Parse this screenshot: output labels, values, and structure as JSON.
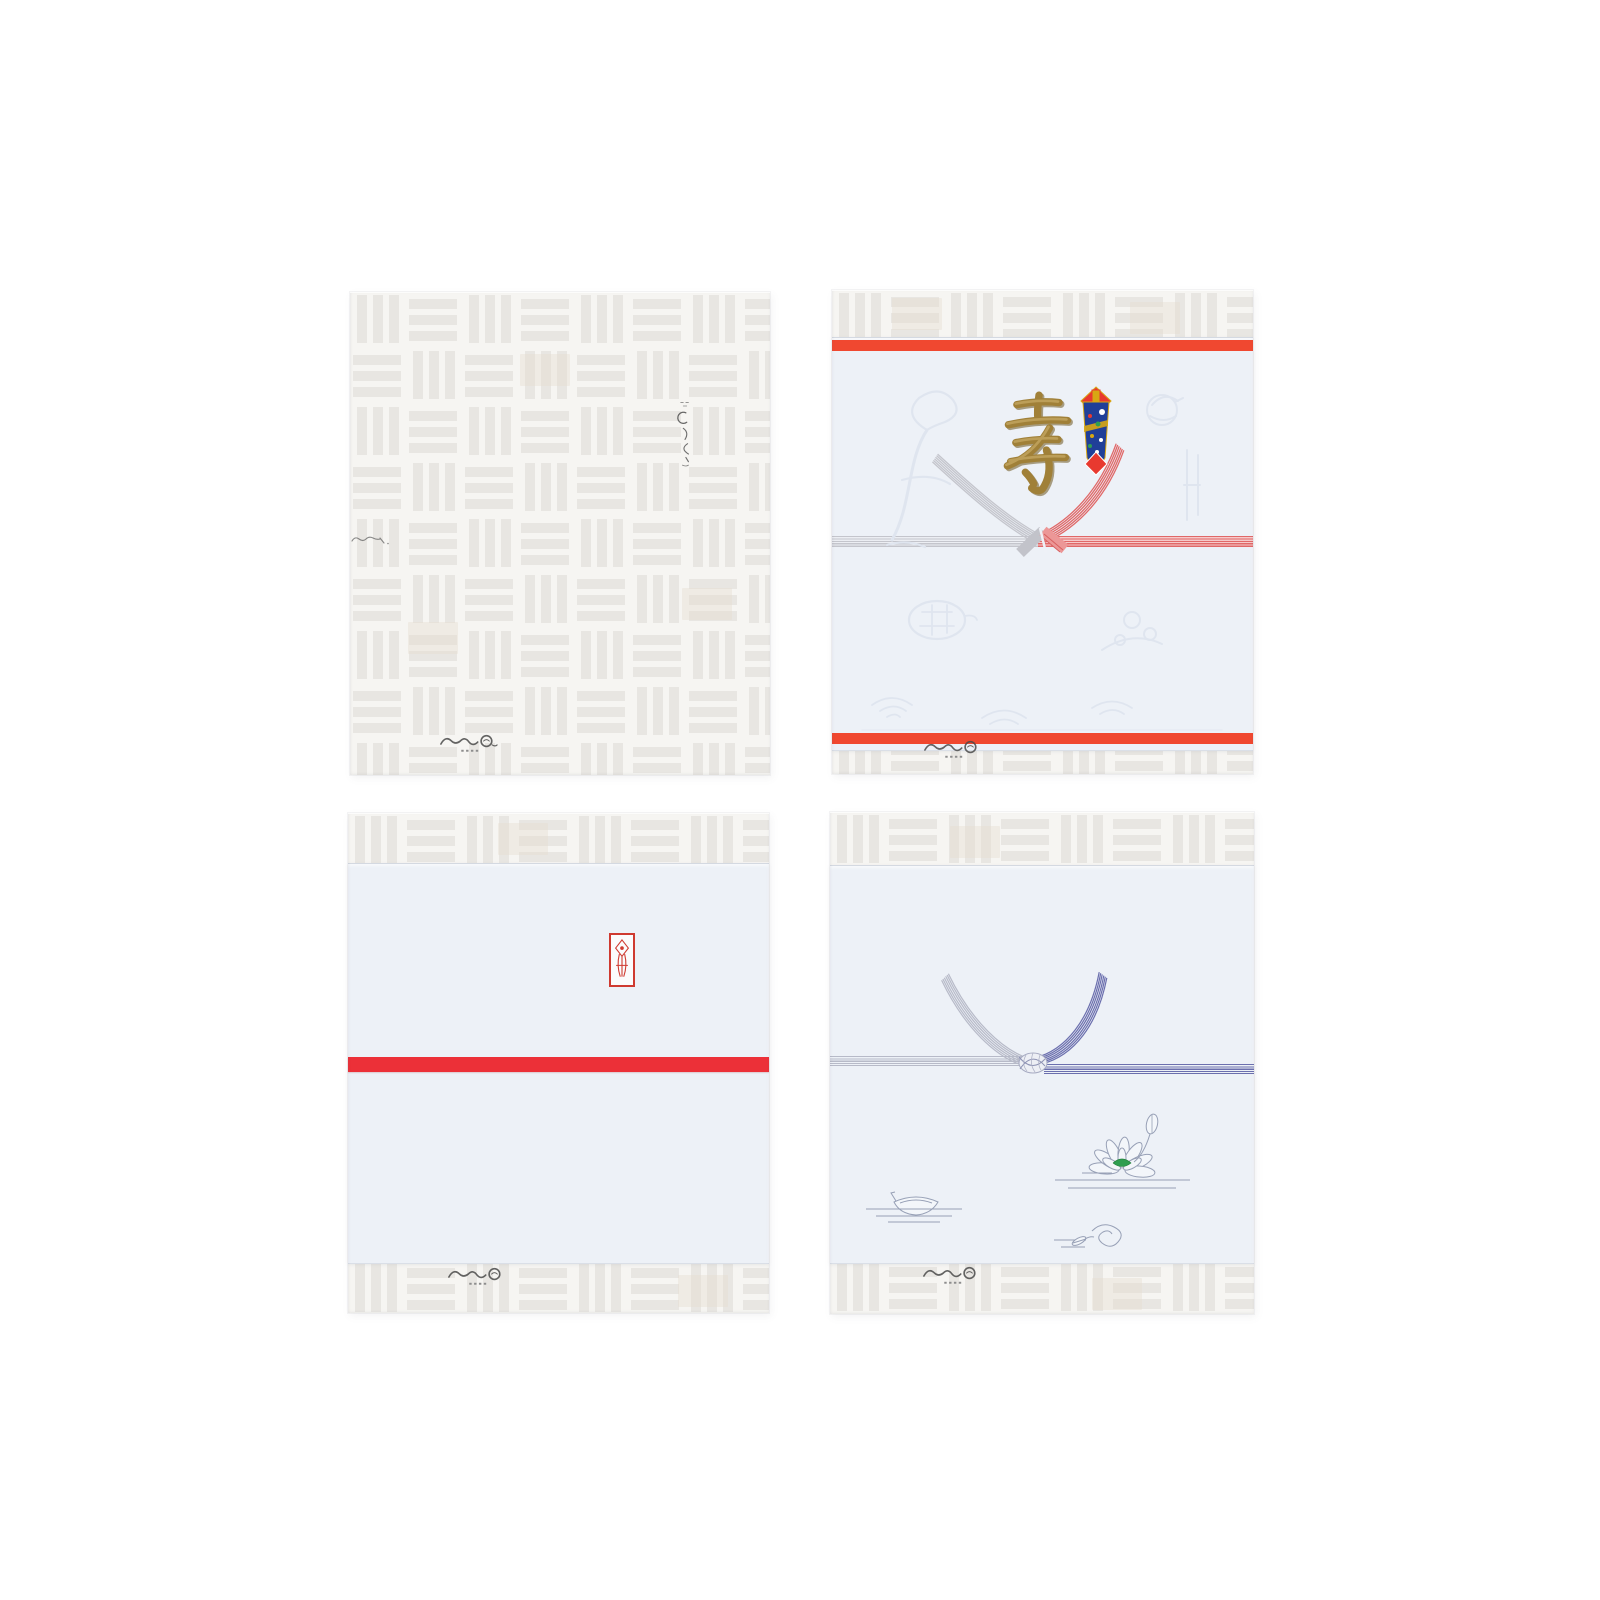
{
  "canvas": {
    "width": 1600,
    "height": 1600,
    "background": "#ffffff"
  },
  "texts": {
    "kotobuki": "寿"
  },
  "packages": [
    {
      "name": "plain-checkered-wrapping",
      "grid": "top-left"
    },
    {
      "name": "celebration-noshi-wrapping",
      "grid": "top-right",
      "kanji": "寿"
    },
    {
      "name": "red-band-noshi-wrapping",
      "grid": "bottom-left"
    },
    {
      "name": "buddhist-lotus-noshi-wrapping",
      "grid": "bottom-right"
    }
  ],
  "icons": {
    "noshi-ornament-icon": "folded-abalone-celebration-decoration",
    "mizuhiki-bow-icon": "red-and-silver-ribbon-knot",
    "mizuhiki-awaji-icon": "purple-and-silver-looped-knot",
    "noshi-stamp-icon": "red-seal-with-noshi-motif",
    "lotus-icon": "outlined-lotus-with-green-center",
    "boat-icon": "small-boat-on-water-lines",
    "cloud-icon": "cloud-scroll-with-leaf",
    "brand-logo-icon": "calligraphic-signature-mark",
    "kotobuki-kanji-icon": "gold-embossed-longevity-character"
  },
  "colors": {
    "page-bg": "#ffffff",
    "wrap-base": "#f6f5f2",
    "wrap-bar": "#e8e6e2",
    "wrap-tint": "#e7ddcf",
    "paper": "#edf1f7",
    "emboss": "#dfe5ef",
    "vermillion": "#f04830",
    "red-stripe": "#ec3038",
    "stamp-red": "#cf3a30",
    "gold": "#a08038",
    "gold-dark": "#6f5820",
    "gold-light": "#c8ab66",
    "silver": "#c4c5cc",
    "silver-pale": "#eceef3",
    "mizu-red": "#e06868",
    "mizu-red-pale": "#f6caca",
    "mizu-purple": "#6b6fae",
    "mizu-lav": "#b7bac8",
    "noshi-blue": "#203f98",
    "noshi-red": "#e8392f",
    "noshi-gold": "#d8a713",
    "green": "#2f9e50",
    "line": "#97a0b6",
    "ink": "#4a4a4a"
  }
}
